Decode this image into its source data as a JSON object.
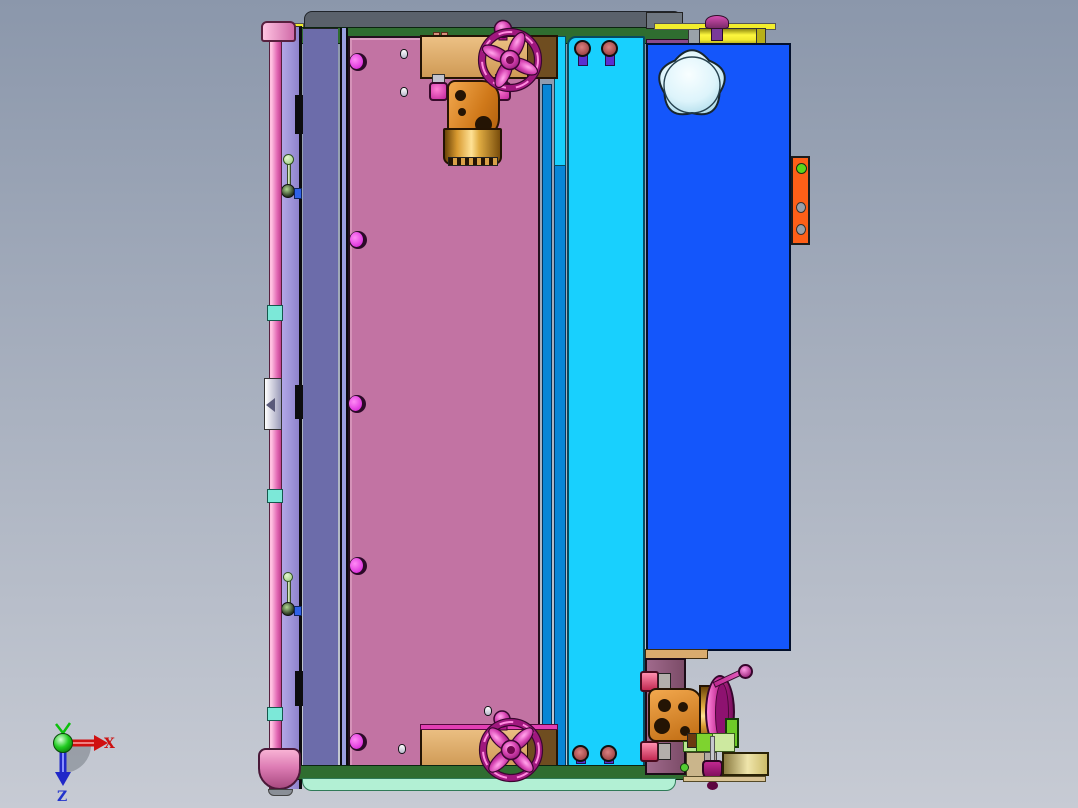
{
  "viewport": {
    "description": "CAD software 3D viewport, orthographic side view of a mold tool assembly with coolant valves and magenta handwheels",
    "view": "side"
  },
  "triad": {
    "x_label": "X",
    "y_label": "Y",
    "z_label": "Z"
  },
  "palette": {
    "bgTop": "#8b97ab",
    "bgBottom": "#c7cbd4",
    "railPink": "#e268b4",
    "railPinkLight": "#ffc0e0",
    "railCap": "#eb9ec4",
    "cyanBand": "#7ce8d8",
    "purpleStrip": "#9b8fd8",
    "slateStrip": "#6c6caa",
    "periwinkle": "#9aa0e0",
    "pinkPanel": "#c273a3",
    "holeMagenta": "#ee55ee",
    "tanBlock": "#d9ab6e",
    "tanDark": "#6f4d20",
    "greenBar": "#2f6d30",
    "mintBar": "#b2f0d4",
    "grayBar": "#5a616b",
    "yellow": "#f2ee2c",
    "orange": "#e8912c",
    "goldLight": "#ffe296",
    "goldDark": "#6b4408",
    "wheelMagenta": "#c02890",
    "wheelLight": "#ff8ade",
    "cyanPanel": "#18d0fe",
    "blueStrip": "#0886d6",
    "bluePanel": "#1456fb",
    "knobWhite": "#eafafe",
    "orangeBracket": "#fe5f18",
    "holeGreen": "#5cd61c",
    "screwRed": "#a04040",
    "screwPink": "#ee4477",
    "screwPurple": "#5a2fd0",
    "purpleBlock": "#8a5a78",
    "brightGreen": "#7ed32f",
    "lightGreen": "#b8e890",
    "khaki": "#efe5ab",
    "axisRed": "#cc1111",
    "axisGreen": "#0cc00c",
    "axisBlue": "#2233cc"
  },
  "parts": [
    {
      "name": "guide-rail-left",
      "color": "#e268b4"
    },
    {
      "name": "rail-top-cap",
      "color": "#eb9ec4"
    },
    {
      "name": "rail-bottom-cap",
      "color": "#dd7cb4"
    },
    {
      "name": "coolant-fittings",
      "color": "#7ce8d8"
    },
    {
      "name": "purple-spacer-strip",
      "color": "#9b8fd8"
    },
    {
      "name": "slate-clamp-plate",
      "color": "#6c6caa"
    },
    {
      "name": "pink-mold-plate",
      "color": "#c273a3"
    },
    {
      "name": "blue-support-strips",
      "color": "#0886d6"
    },
    {
      "name": "cyan-ejector-plate",
      "color": "#18d0fe"
    },
    {
      "name": "blue-core-plate",
      "color": "#1456fb"
    },
    {
      "name": "white-star-knob",
      "color": "#eafafe"
    },
    {
      "name": "orange-side-bracket",
      "color": "#fe5f18"
    },
    {
      "name": "top-rail-bar",
      "color": "#5a616b"
    },
    {
      "name": "green-frame-bars",
      "color": "#2f6d30"
    },
    {
      "name": "mint-base-bar",
      "color": "#b2f0d4"
    },
    {
      "name": "yellow-end-plate",
      "color": "#f2ee2c"
    },
    {
      "name": "tan-clamp-blocks",
      "color": "#d9ab6e"
    },
    {
      "name": "brass-valve-bodies",
      "color": "#e8912c"
    },
    {
      "name": "magenta-handwheels",
      "color": "#c02890"
    },
    {
      "name": "purple-corner-block",
      "color": "#8a5a78"
    },
    {
      "name": "khaki-wedge-plate",
      "color": "#efe5ab"
    }
  ]
}
